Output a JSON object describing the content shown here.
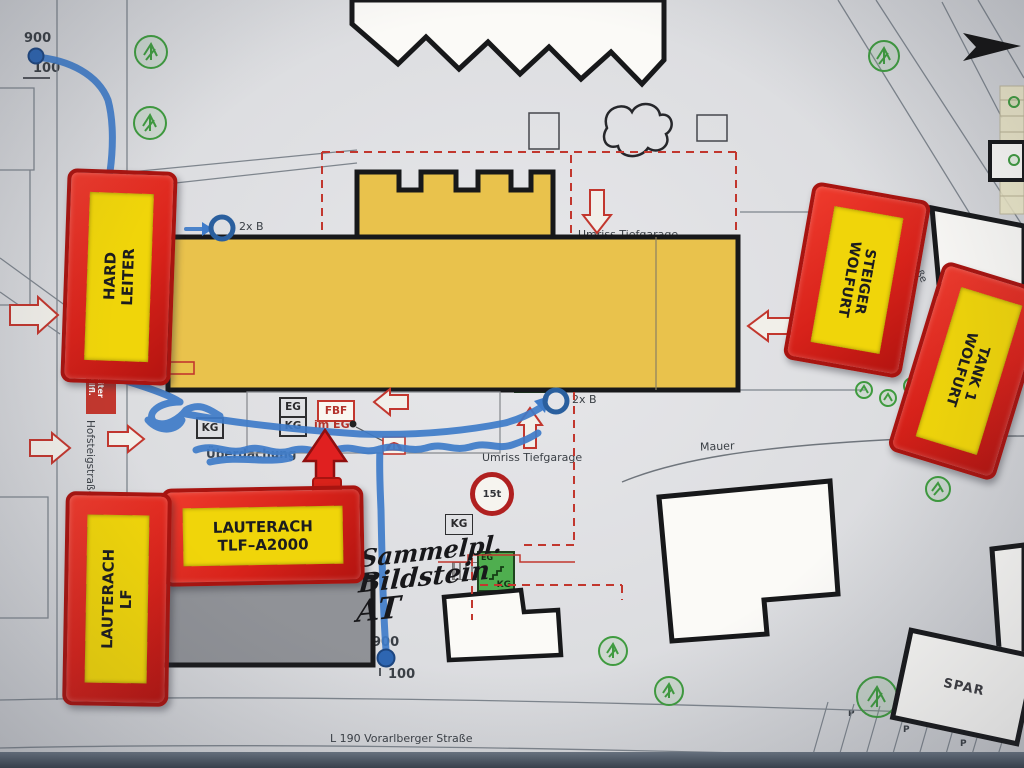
{
  "colors": {
    "building_yellow": "#e9c24c",
    "block_red": "#d8221a",
    "label_yellow": "#f0d50a",
    "stair_green": "#4fae4f",
    "marking_red": "#c2372e",
    "hose_blue": "#3f7cc9",
    "tree_green": "#3f9b3f"
  },
  "map": {
    "streets": {
      "bottom": "L 190 Vorarlberger Straße",
      "left": "Hofsteigstraße",
      "right": "Staufnerstraße"
    },
    "hydrant_top": {
      "flow": "900",
      "pressure": "100"
    },
    "hydrant_bottom": {
      "flow": "900",
      "pressure": "100"
    },
    "b_connection_top": "2x B",
    "b_connection_mid": "2x B",
    "umriss_top": "Umriss Tiefgarage",
    "umriss_bottom": "Umriss Tiefgarage",
    "haus": "Haus 1",
    "nb_dh": "NB DH",
    "floors": {
      "f2": "2",
      "f1": "1",
      "eg": "EG",
      "kg": "KG"
    },
    "bmz": {
      "label": "BMZ",
      "loc": "im KG"
    },
    "bmpa1": {
      "loc": "im 1+2",
      "label": "BM-PA"
    },
    "bmpa2": {
      "loc": "im EG",
      "label": "BM-PA"
    },
    "fbf": {
      "label": "FBF",
      "loc": "im EG"
    },
    "leiter": "Leiter",
    "stairs": {
      "s1_tl": "2",
      "s1_br": "KG",
      "sx": "KG",
      "s2_tl": "D",
      "s2_br": "2",
      "s3_tl": "2",
      "s3_br": "KG",
      "s4_tl": "EG",
      "s4_br": "KG"
    },
    "kg1": "KG",
    "kg2": "KG",
    "weight": "15t",
    "mauer": "Mauer",
    "ueberdachung": "Überdachung",
    "rohbau": "Rohbau",
    "spar": "SPAR",
    "parking": "P",
    "aufstell": {
      "l1": "Aufstellfl.",
      "l2": "Drehleiter"
    },
    "handwriting": {
      "l1": "Sammelpl.",
      "l2": "Bildstein",
      "l3": "AT"
    }
  },
  "vehicles": {
    "hard": {
      "l1": "HARD",
      "l2": "LEITER"
    },
    "steiger": {
      "l1": "WOLFURT",
      "l2": "STEIGER"
    },
    "tank": {
      "l1": "WOLFURT",
      "l2": "TANK 1"
    },
    "tlf": {
      "l1": "LAUTERACH",
      "l2": "TLF–A2000"
    },
    "lf": {
      "l1": "LAUTERACH",
      "l2": "LF"
    }
  }
}
